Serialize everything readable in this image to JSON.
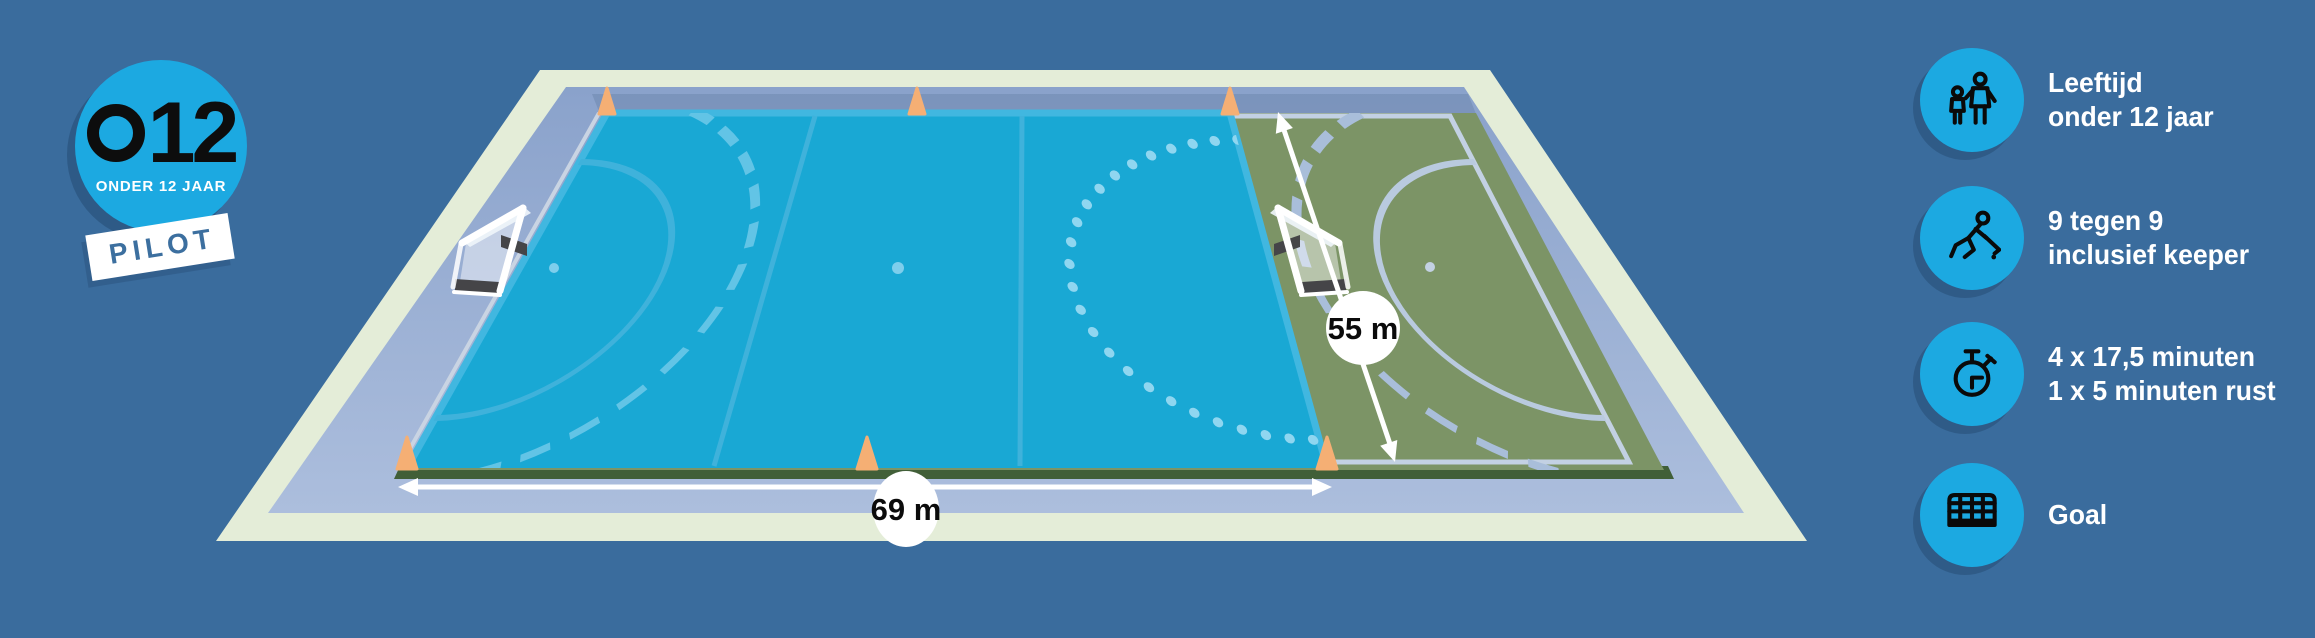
{
  "badge": {
    "code": "O12",
    "code_number": "12",
    "subtitle": "ONDER 12 JAAR",
    "tag": "PILOT"
  },
  "field": {
    "length_label": "69 m",
    "width_label": "55 m"
  },
  "legend": {
    "items": [
      {
        "icon": "adult-child-icon",
        "lines": [
          "Leeftijd",
          "onder 12 jaar"
        ]
      },
      {
        "icon": "hockey-player-icon",
        "lines": [
          "9 tegen 9",
          "inclusief keeper"
        ]
      },
      {
        "icon": "stopwatch-icon",
        "lines": [
          "4 x 17,5 minuten",
          "1 x 5 minuten rust"
        ]
      },
      {
        "icon": "goal-net-icon",
        "lines": [
          "Goal"
        ]
      }
    ]
  },
  "colors": {
    "background": "#3A6C9D",
    "accent_blue": "#1CA9E1",
    "field_cyan": "#19A8D4",
    "field_line_blue": "#3FB2DB",
    "field_green": "#7C9466",
    "green_line_pale": "#C3D1E3",
    "border_pale_green": "#E4EDD8",
    "runoff_periwinkle": "#93A9CF",
    "cone_orange": "#F5AF74",
    "pilot_text_blue": "#3C6F9F"
  }
}
